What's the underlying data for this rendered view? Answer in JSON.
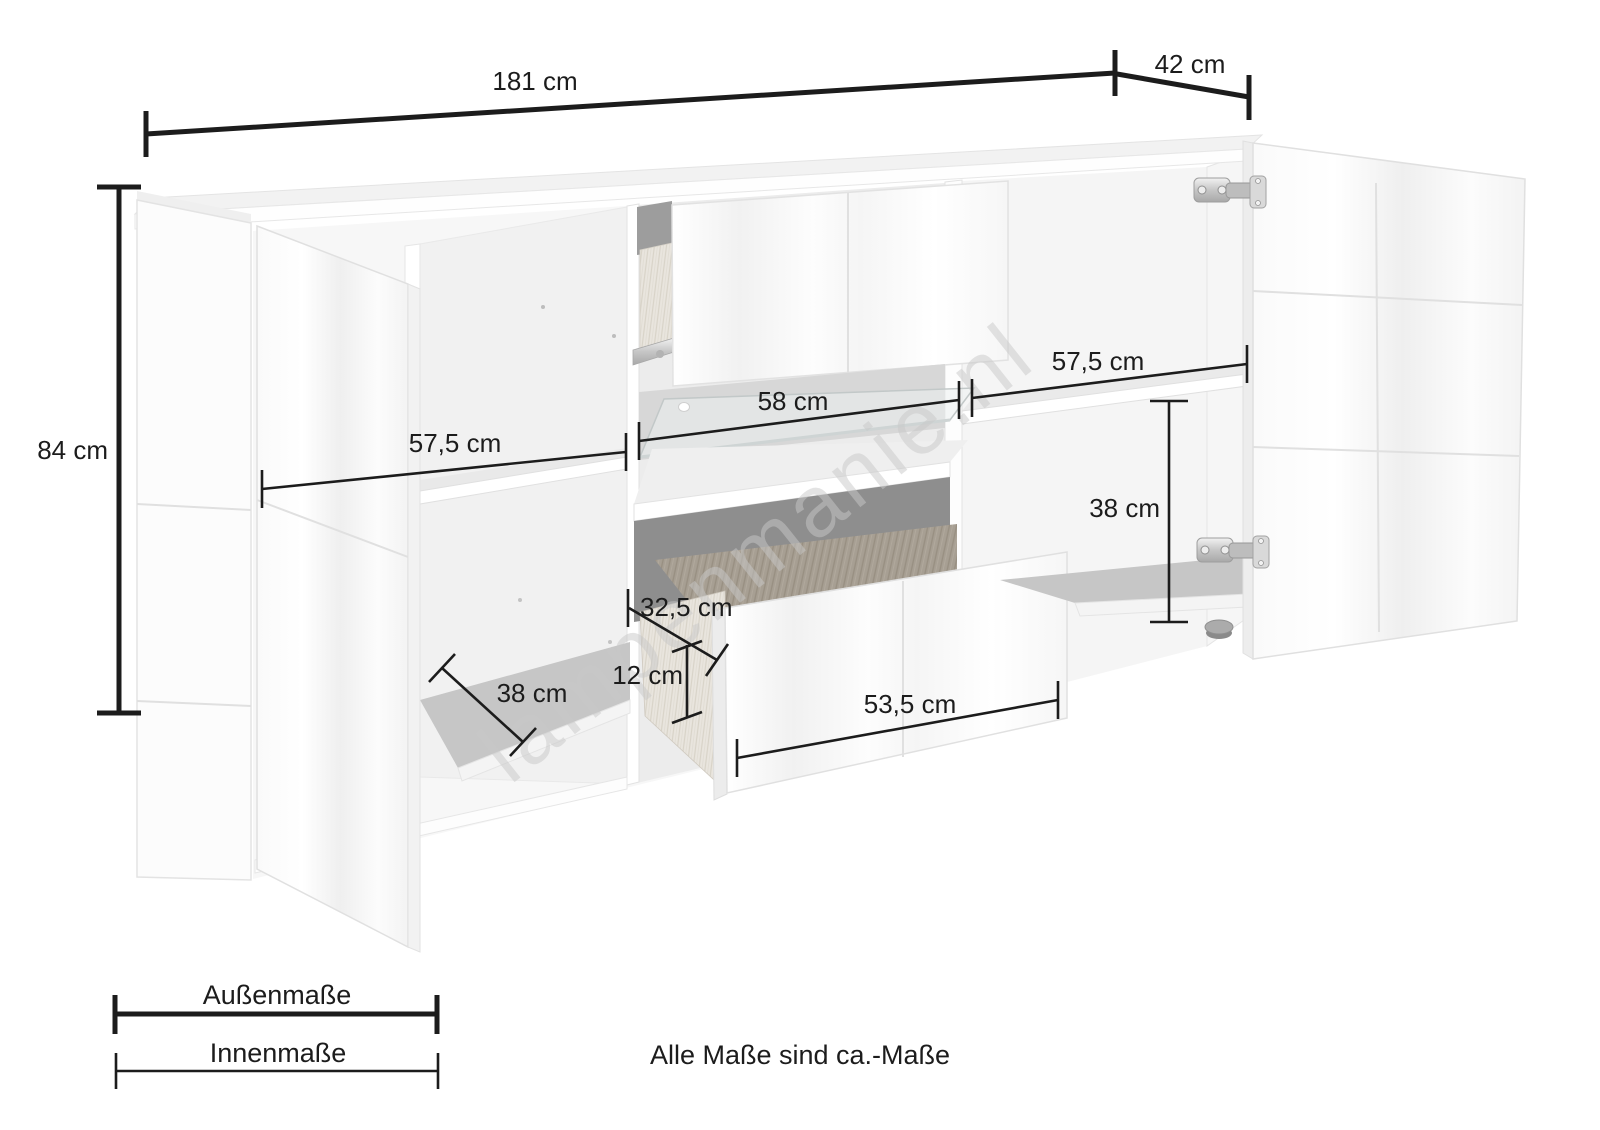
{
  "diagram": {
    "watermark": "lampenmanie.nl",
    "note": "Alle Maße sind ca.-Maße"
  },
  "outer_dimensions": {
    "width": "181 cm",
    "depth": "42 cm",
    "height": "84 cm"
  },
  "inner_dimensions": {
    "left_width": "57,5 cm",
    "middle_width": "58 cm",
    "right_width": "57,5 cm",
    "right_height": "38 cm",
    "drawer_depth": "32,5 cm",
    "drawer_height": "12 cm",
    "drawer_width": "53,5 cm",
    "left_depth": "38 cm"
  },
  "legend": {
    "outer": "Außenmaße",
    "inner": "Innenmaße"
  },
  "colors": {
    "dimension_line": "#1c1c1c",
    "watermark": "#c9c9c9",
    "furniture_edge": "#e2e2e2",
    "interior_shadow": "#c6c6c6",
    "dark_recess": "#8e8e8e",
    "hinge_silver": "#c8c8c8"
  }
}
